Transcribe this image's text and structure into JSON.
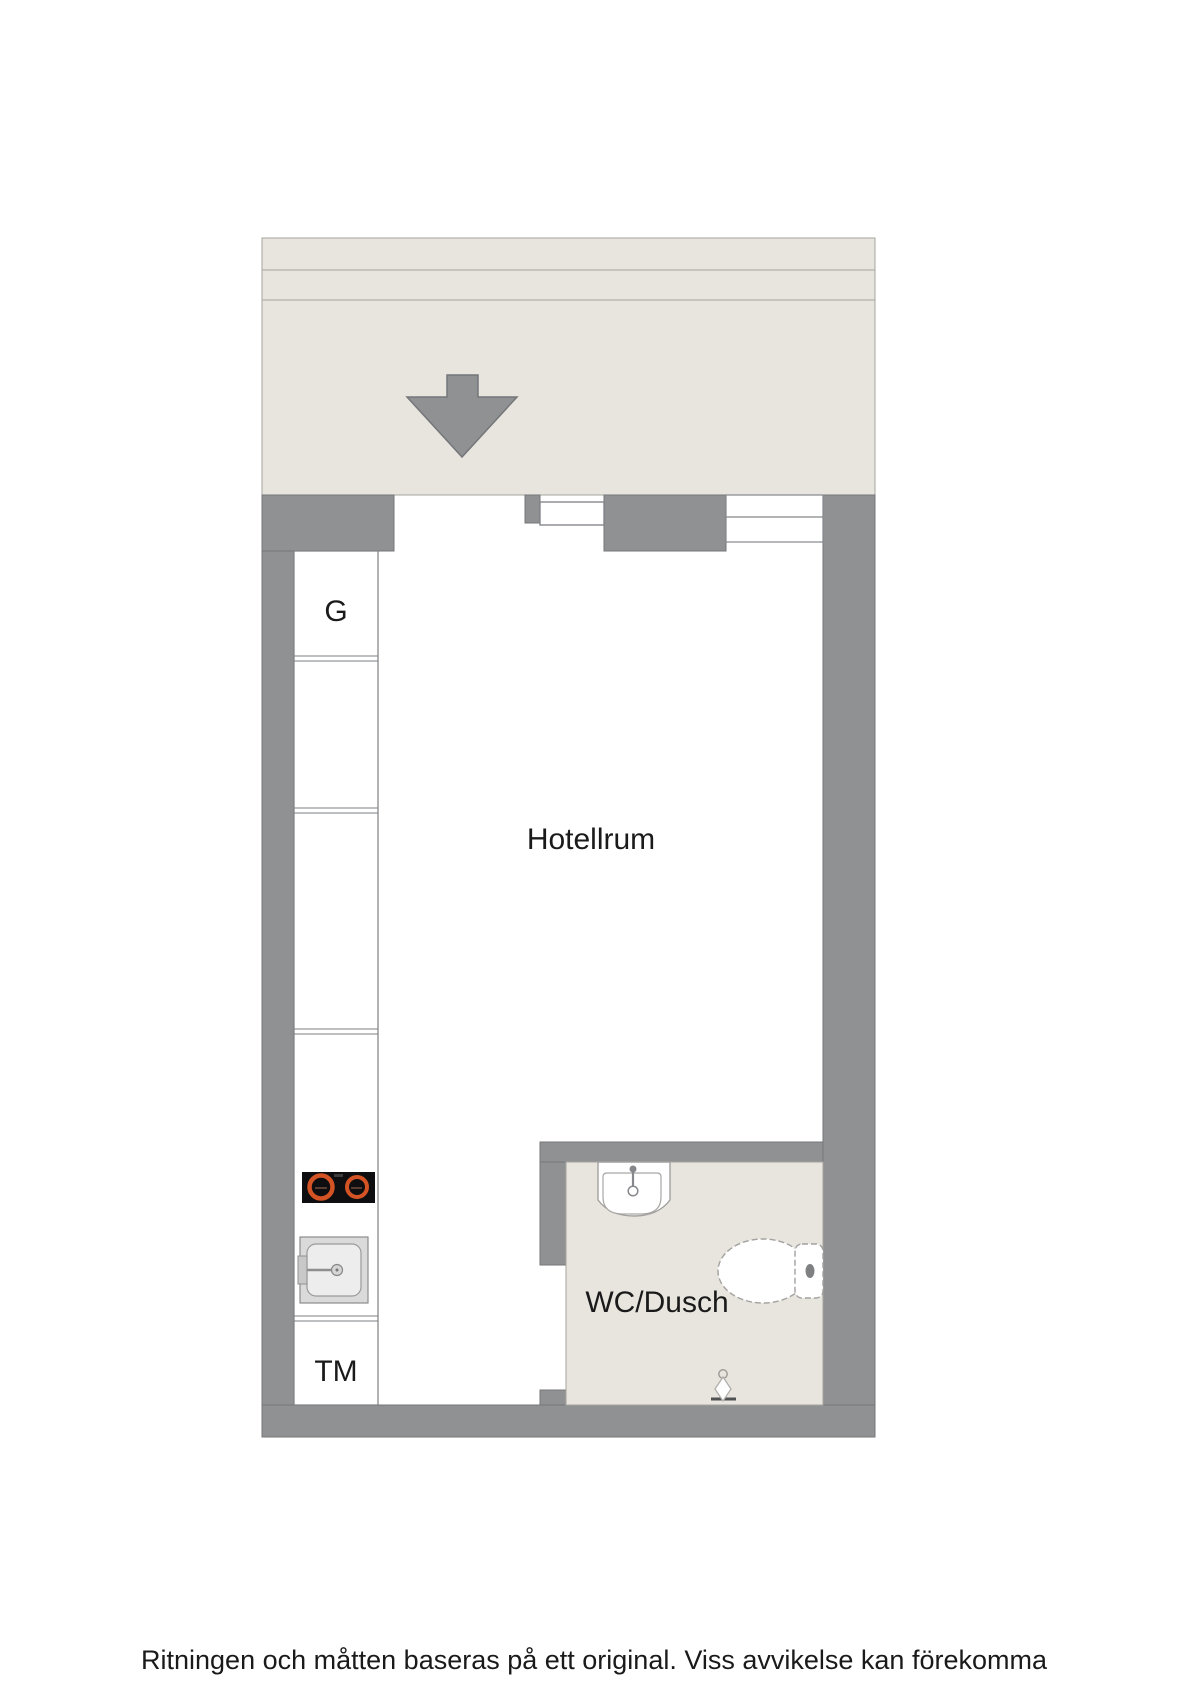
{
  "colors": {
    "wall": "#8f9193",
    "wall-outline": "#74767a",
    "floor": "#e8e5de",
    "floor-line": "#a6a49c",
    "cabinet-outline": "#7d7f81",
    "fixture-outline": "#a3a19f",
    "text": "#1a1a1a",
    "stove": "#0e0e10",
    "burner": "#d35324"
  },
  "plan": {
    "rooms": [
      {
        "id": "hotellrum",
        "label": "Hotellrum"
      },
      {
        "id": "wc-dusch",
        "label": "WC/Dusch"
      }
    ],
    "closet_label": "G",
    "washing_machine_label": "TM",
    "fixtures": [
      "entrance-arrow",
      "entrance-door",
      "window",
      "stove",
      "kitchen-sink",
      "washbasin",
      "toilet",
      "shower"
    ]
  },
  "footer": {
    "disclaimer": "Ritningen och måtten baseras på ett original. Viss avvikelse kan förekomma"
  }
}
